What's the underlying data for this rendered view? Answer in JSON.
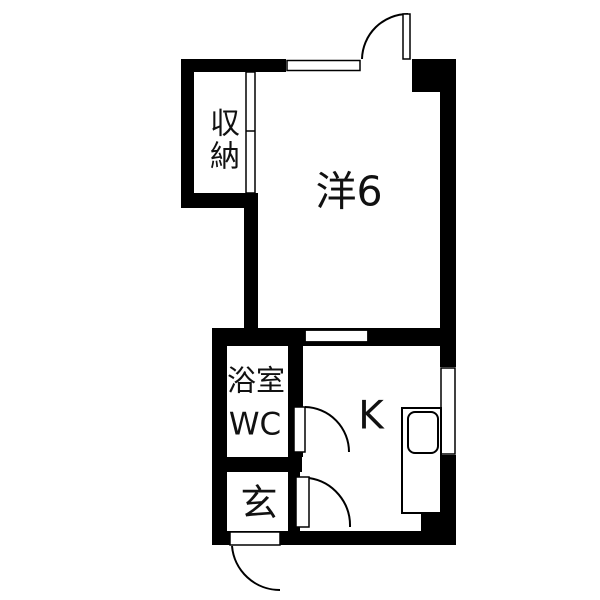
{
  "floorplan": {
    "kind": "Japanese apartment floor plan",
    "colors": {
      "wall": "#000000",
      "floor": "#ffffff",
      "line": "#000000",
      "text": "#111111"
    },
    "rooms": [
      {
        "id": "western_room",
        "label": "洋6"
      },
      {
        "id": "closet",
        "label": "収納",
        "label_orientation": "vertical"
      },
      {
        "id": "bathroom",
        "label_line1": "浴室",
        "label_line2": "WC"
      },
      {
        "id": "entrance",
        "label": "玄"
      },
      {
        "id": "kitchen",
        "label": "K"
      }
    ],
    "fixtures": [
      "window-top-wall",
      "swing-door-top-exterior",
      "window-kitchen-top-wall",
      "window-kitchen-right-wall",
      "swing-door-bathroom",
      "swing-door-entrance-to-kitchen",
      "entrance-swing-door-exterior",
      "closet-sliding-partition",
      "kitchen-counter",
      "kitchen-sink"
    ]
  }
}
